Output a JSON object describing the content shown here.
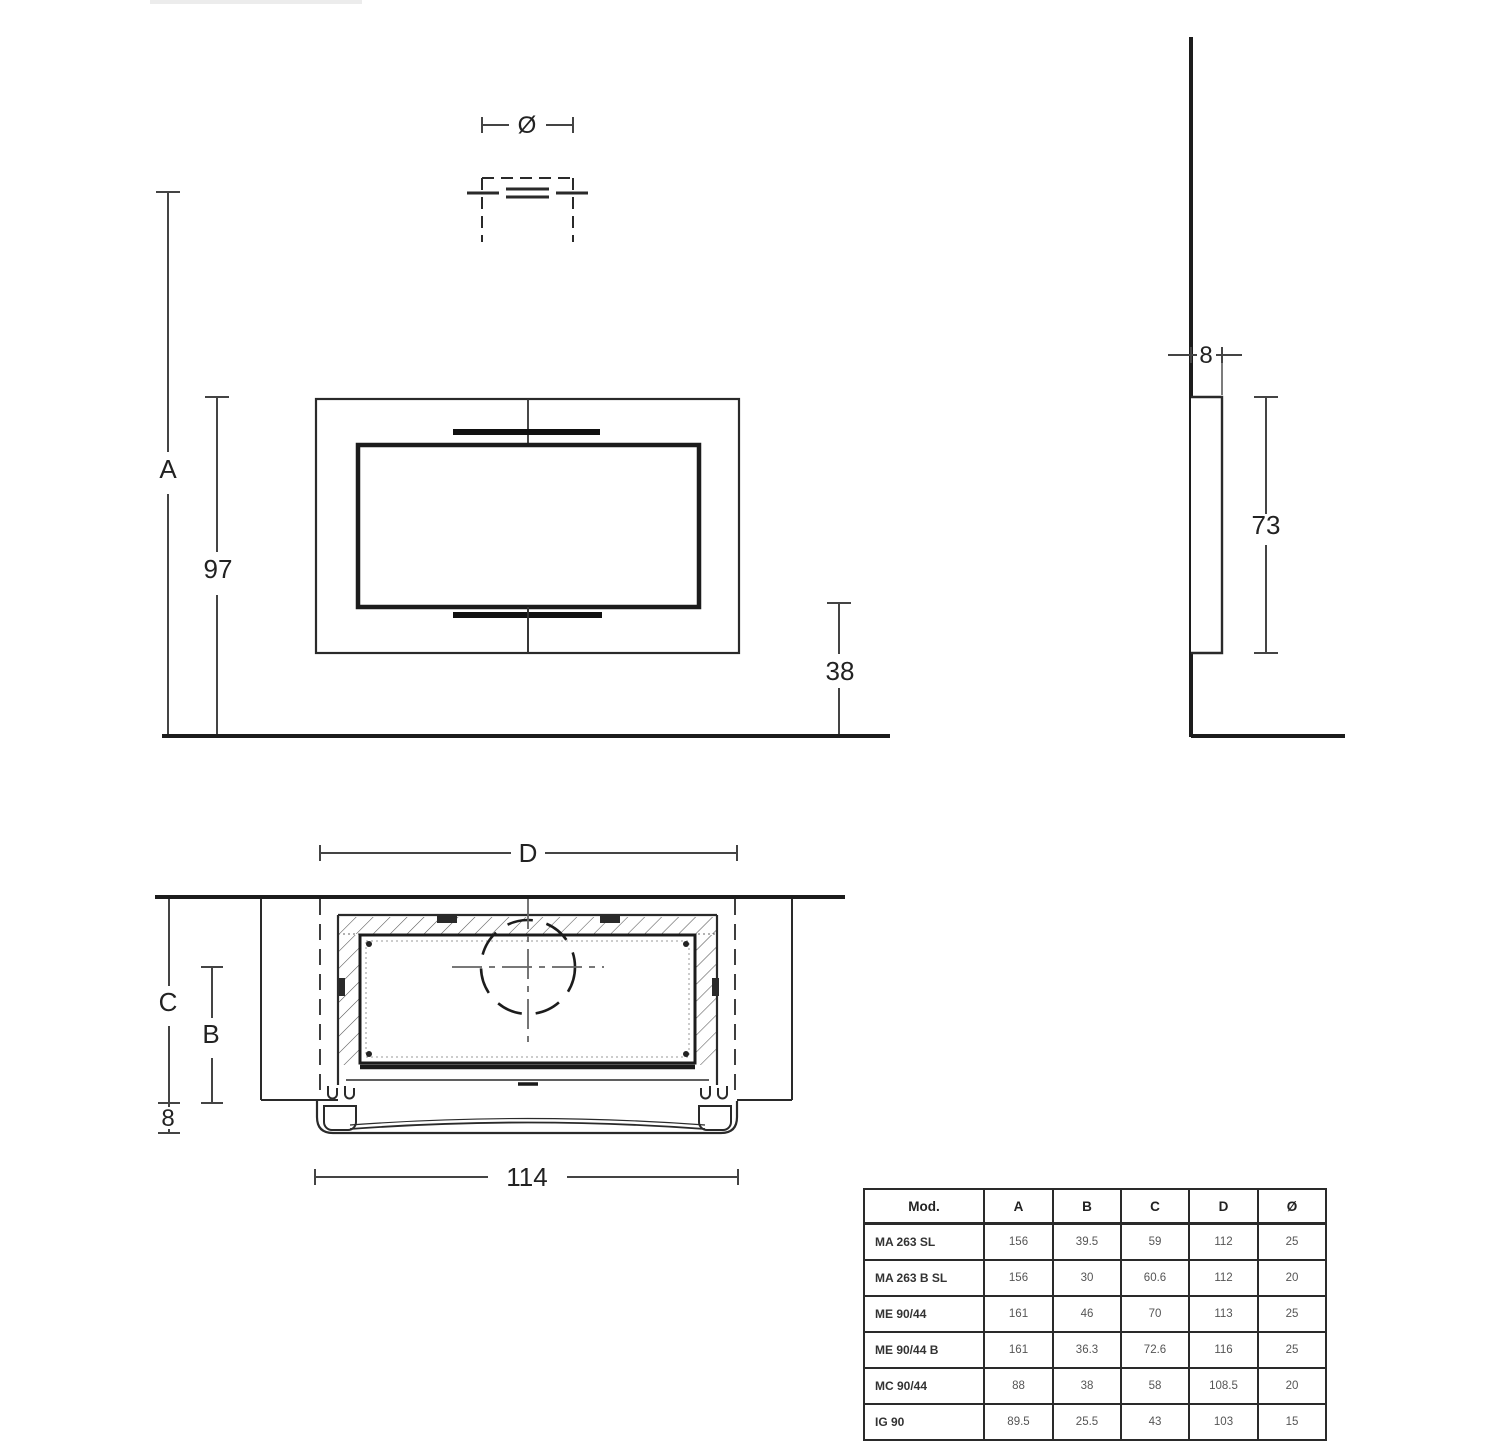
{
  "page": {
    "background": "#ffffff",
    "line_color": "#222222",
    "dim_line_color": "#444444"
  },
  "front_view": {
    "diameter_label": "Ø",
    "height_total_label": "A",
    "height_97": "97",
    "height_38": "38"
  },
  "side_view": {
    "depth_8": "8",
    "height_73": "73"
  },
  "plan_view": {
    "width_d_label": "D",
    "depth_c_label": "C",
    "depth_b_label": "B",
    "depth_8": "8",
    "width_114": "114"
  },
  "spec_table": {
    "headers": [
      "Mod.",
      "A",
      "B",
      "C",
      "D",
      "Ø"
    ],
    "rows": [
      {
        "model": "MA 263 SL",
        "values": [
          "156",
          "39.5",
          "59",
          "112",
          "25"
        ]
      },
      {
        "model": "MA 263 B SL",
        "values": [
          "156",
          "30",
          "60.6",
          "112",
          "20"
        ]
      },
      {
        "model": "ME 90/44",
        "values": [
          "161",
          "46",
          "70",
          "113",
          "25"
        ]
      },
      {
        "model": "ME 90/44 B",
        "values": [
          "161",
          "36.3",
          "72.6",
          "116",
          "25"
        ]
      },
      {
        "model": "MC 90/44",
        "values": [
          "88",
          "38",
          "58",
          "108.5",
          "20"
        ]
      },
      {
        "model": "IG 90",
        "values": [
          "89.5",
          "25.5",
          "43",
          "103",
          "15"
        ]
      }
    ]
  }
}
